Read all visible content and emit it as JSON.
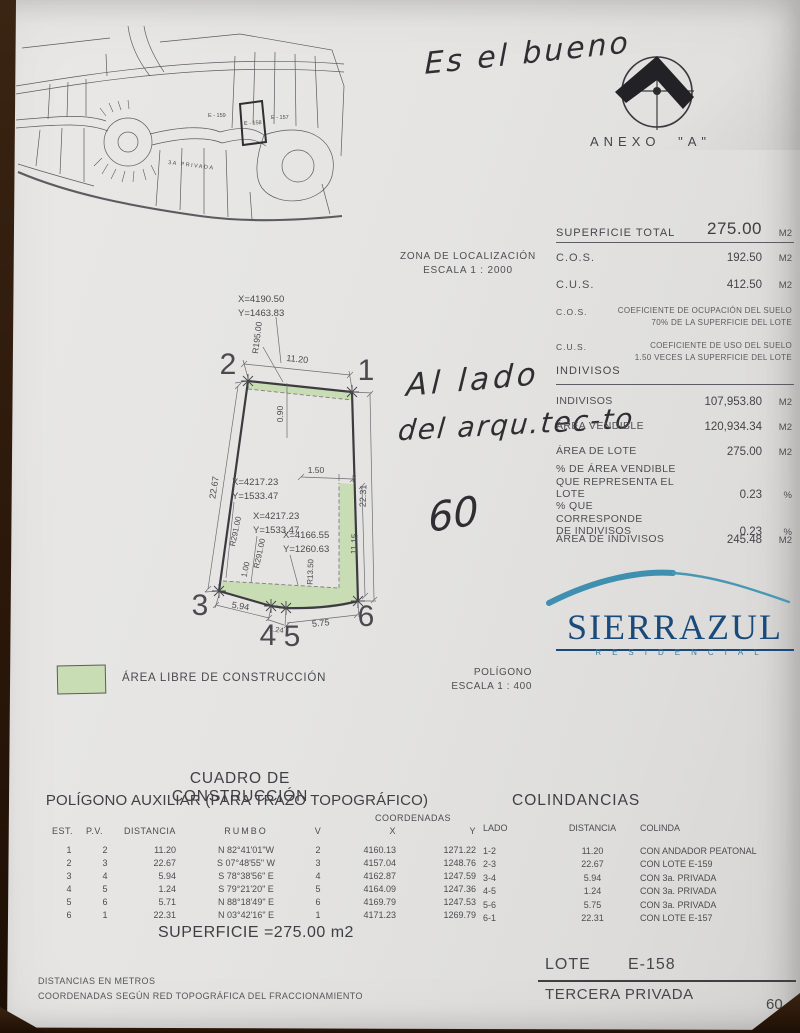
{
  "handwriting": {
    "top": "Es el bueno",
    "line1": "Al lado",
    "line2": "del arqu.tec-to",
    "number": "60"
  },
  "anexo": {
    "label": "ANEXO \"A\""
  },
  "zona": {
    "line1": "ZONA DE LOCALIZACIÓN",
    "line2": "ESCALA 1 : 2000"
  },
  "map": {
    "lot_left": "E - 159",
    "lot_center": "E - 158",
    "lot_right": "E - 157",
    "street": "3A PRIVADA"
  },
  "superficie": {
    "title": "SUPERFICIE TOTAL",
    "total": "275.00",
    "unit": "M2",
    "cos_label": "C.O.S.",
    "cos_value": "192.50",
    "cos_unit": "M2",
    "cus_label": "C.U.S.",
    "cus_value": "412.50",
    "cus_unit": "M2",
    "note1_label": "C.O.S.",
    "note1_line1": "COEFICIENTE DE OCUPACIÓN DEL SUELO",
    "note1_line2": "70% DE LA SUPERFICIE DEL LOTE",
    "note2_label": "C.U.S.",
    "note2_line1": "COEFICIENTE DE USO DEL SUELO",
    "note2_line2": "1.50 VECES LA SUPERFICIE DEL LOTE"
  },
  "indivisos": {
    "title": "INDIVISOS",
    "r1_label": "INDIVISOS",
    "r1_value": "107,953.80",
    "r1_unit": "M2",
    "r2_label": "ÁREA VENDIBLE",
    "r2_value": "120,934.34",
    "r2_unit": "M2",
    "r3_label": "ÁREA DE LOTE",
    "r3_value": "275.00",
    "r3_unit": "M2",
    "r4_label1": "% DE ÁREA VENDIBLE",
    "r4_label2": "QUE REPRESENTA EL LOTE",
    "r4_value": "0.23",
    "r4_unit": "%",
    "r5_label1": "% QUE CORRESPONDE",
    "r5_label2": "DE INDIVISOS",
    "r5_value": "0.23",
    "r5_unit": "%",
    "r6_label": "ÁREA DE INDIVISOS",
    "r6_value": "245.48",
    "r6_unit": "M2"
  },
  "plot": {
    "top_coord_x": "X=4190.50",
    "top_coord_y": "Y=1463.83",
    "coord1_x": "X=4217.23",
    "coord1_y": "Y=1533.47",
    "coord2_x": "X=4217.23",
    "coord2_y": "Y=1533.47",
    "coord3_x": "X=4166.55",
    "coord3_y": "Y=1260.63",
    "radius_top": "R195.00",
    "dim_top": "11.20",
    "dim_top_offset": "0.90",
    "dim_left": "22.67",
    "dim_right": "22.31",
    "dim_right_inner": "11.15",
    "dim_notch": "1.50",
    "radius_left1": "R291.00",
    "radius_left2": "R291.00",
    "dim_strip": "1.00",
    "radius_corner": "R13.50",
    "dim_bottom1": "5.94",
    "dim_bottom2": "1.24",
    "dim_bottom3": "5.75",
    "v1": "1",
    "v2": "2",
    "v3": "3",
    "v4": "4",
    "v5": "5",
    "v6": "6"
  },
  "poligono": {
    "line1": "POLÍGONO",
    "line2": "ESCALA 1 : 400"
  },
  "legend": {
    "label": "ÁREA LIBRE DE CONSTRUCCIÓN"
  },
  "brand": {
    "name": "SIERRAZUL",
    "sub": "RESIDENCIAL"
  },
  "cuadro": {
    "title": "CUADRO DE CONSTRUCCIÓN",
    "subtitle": "POLÍGONO AUXILIAR (PARA TRAZO TOPOGRÁFICO)",
    "h_est": "EST.",
    "h_pv": "P.V.",
    "h_dist": "DISTANCIA",
    "h_rumbo": "RUMBO",
    "h_v": "V",
    "h_coord": "COORDENADAS",
    "h_x": "X",
    "h_y": "Y",
    "rows": [
      [
        "1",
        "2",
        "11.20",
        "N 82°41'01\"W",
        "2",
        "4160.13",
        "1271.22"
      ],
      [
        "2",
        "3",
        "22.67",
        "S 07°48'55\" W",
        "3",
        "4157.04",
        "1248.76"
      ],
      [
        "3",
        "4",
        "5.94",
        "S 78°38'56\" E",
        "4",
        "4162.87",
        "1247.59"
      ],
      [
        "4",
        "5",
        "1.24",
        "S 79°21'20\" E",
        "5",
        "4164.09",
        "1247.36"
      ],
      [
        "5",
        "6",
        "5.71",
        "N 88°18'49\" E",
        "6",
        "4169.79",
        "1247.53"
      ],
      [
        "6",
        "1",
        "22.31",
        "N 03°42'16\" E",
        "1",
        "4171.23",
        "1269.79"
      ]
    ],
    "superficie": "SUPERFICIE =275.00 m2"
  },
  "colindancias": {
    "title": "COLINDANCIAS",
    "h_lado": "LADO",
    "h_dist": "DISTANCIA",
    "h_colinda": "COLINDA",
    "rows": [
      [
        "1-2",
        "11.20",
        "CON ANDADOR PEATONAL"
      ],
      [
        "2-3",
        "22.67",
        "CON LOTE E-159"
      ],
      [
        "3-4",
        "5.94",
        "CON 3a. PRIVADA"
      ],
      [
        "4-5",
        "1.24",
        "CON 3a. PRIVADA"
      ],
      [
        "5-6",
        "5.75",
        "CON 3a. PRIVADA"
      ],
      [
        "6-1",
        "22.31",
        "CON LOTE E-157"
      ]
    ]
  },
  "footer": {
    "note1": "DISTANCIAS EN METROS",
    "note2": "COORDENADAS SEGÚN RED TOPOGRÁFICA DEL FRACCIONAMIENTO",
    "lote_label": "LOTE",
    "lote_value": "E-158",
    "privada": "TERCERA PRIVADA",
    "number": "60"
  },
  "colors": {
    "green": "#c9ddb5",
    "blue_dark": "#184a7b",
    "blue_swoosh": "#3e8fb0",
    "paper": "#e5e4e2",
    "wood": "#2a1709"
  }
}
